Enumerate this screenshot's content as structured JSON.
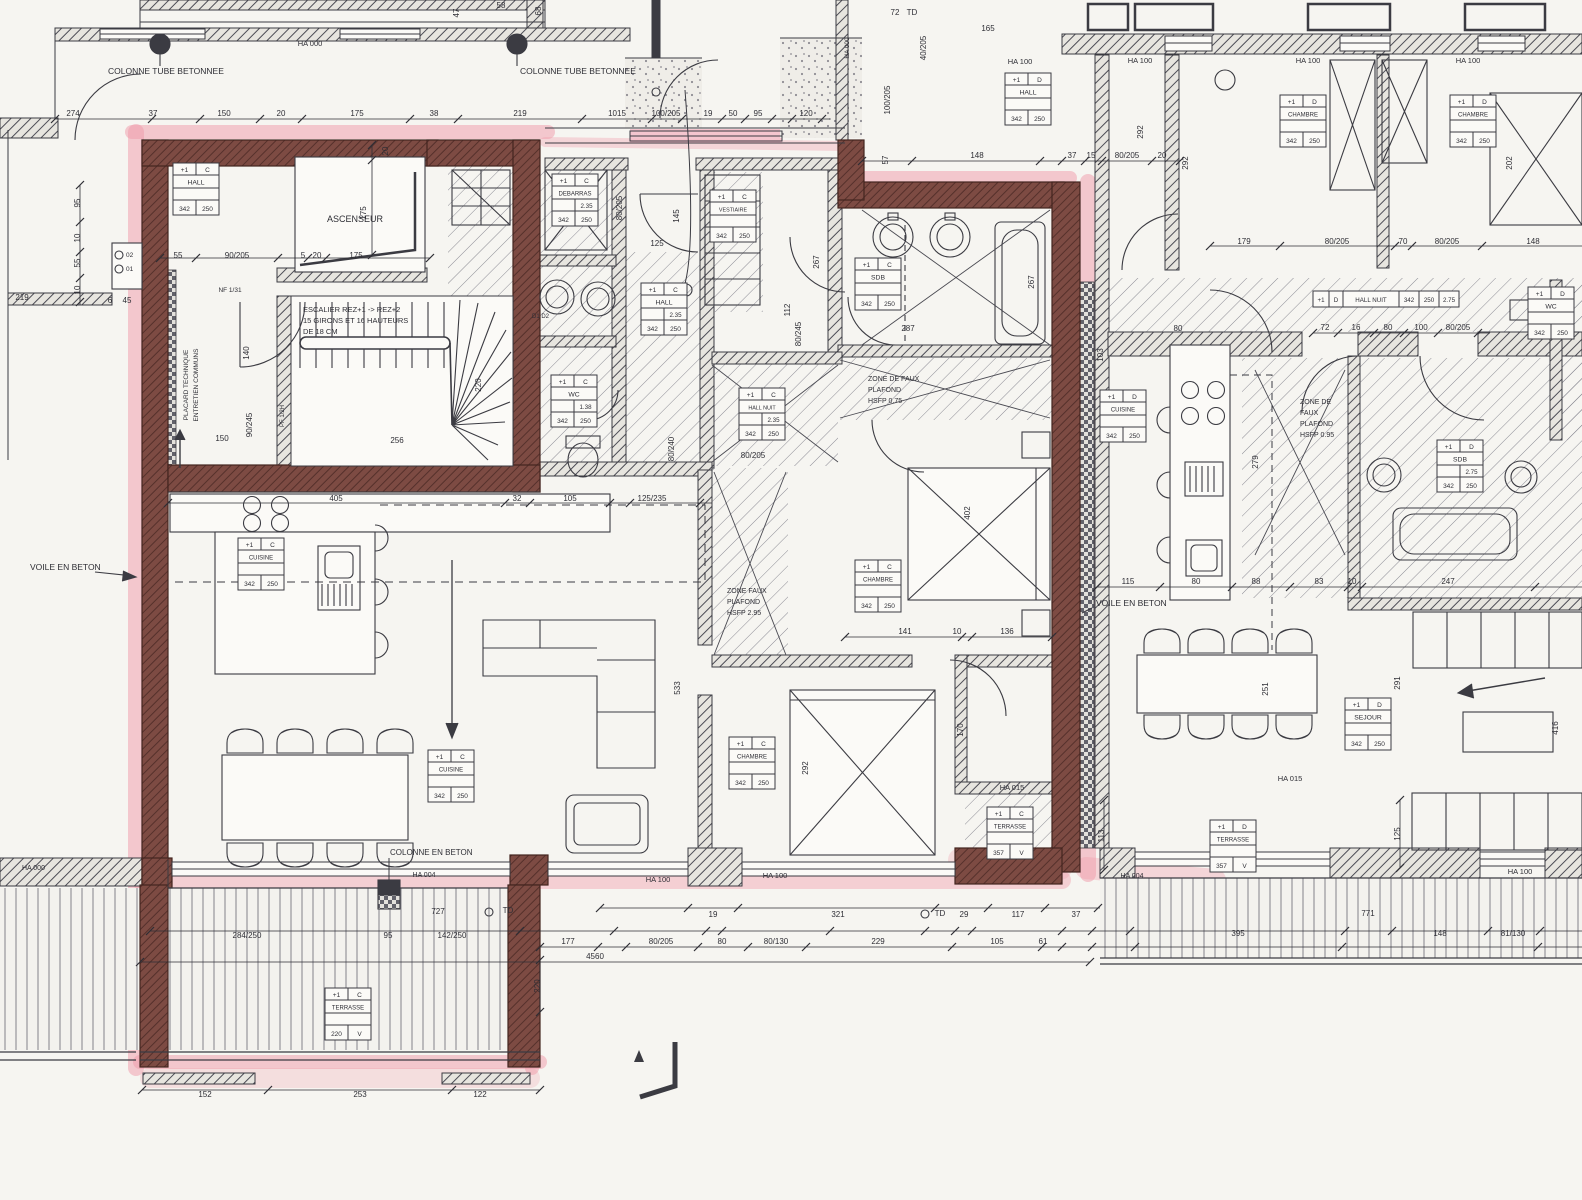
{
  "drawing": {
    "kind": "architectural floor plan scan",
    "paper_color": "#f6f5f1",
    "ink_color": "#3b3b42",
    "highlight_pink": "#f09aa9",
    "highlight_wall": "#7a4a42",
    "tag_code_a": "342",
    "tag_code_b": "250",
    "floor_code": "+1"
  },
  "room_tags": [
    {
      "n": "tag-hall-main",
      "f": "+1",
      "l": "C",
      "name": "HALL",
      "v": "",
      "a": "342",
      "b": "250",
      "x": 173,
      "y": 163,
      "o": "v"
    },
    {
      "n": "tag-debarras",
      "f": "+1",
      "l": "C",
      "name": "DEBARRAS",
      "v": "2.35",
      "a": "342",
      "b": "250",
      "x": 552,
      "y": 174,
      "o": "v"
    },
    {
      "n": "tag-vestiaire",
      "f": "+1",
      "l": "C",
      "name": "VESTIAIRE",
      "v": "",
      "a": "342",
      "b": "250",
      "x": 710,
      "y": 190,
      "o": "v"
    },
    {
      "n": "tag-hall-center",
      "f": "+1",
      "l": "C",
      "name": "HALL",
      "v": "2.35",
      "a": "342",
      "b": "250",
      "x": 641,
      "y": 283,
      "o": "v"
    },
    {
      "n": "tag-wc-main",
      "f": "+1",
      "l": "C",
      "name": "WC",
      "v": "1.38",
      "a": "342",
      "b": "250",
      "x": 551,
      "y": 375,
      "o": "v"
    },
    {
      "n": "tag-sdb-main",
      "f": "+1",
      "l": "C",
      "name": "SDB",
      "v": "",
      "a": "342",
      "b": "250",
      "x": 855,
      "y": 258,
      "o": "v"
    },
    {
      "n": "tag-chambre-main-1",
      "f": "+1",
      "l": "C",
      "name": "CHAMBRE",
      "v": "",
      "a": "342",
      "b": "250",
      "x": 855,
      "y": 560,
      "o": "v"
    },
    {
      "n": "tag-chambre-main-2",
      "f": "+1",
      "l": "C",
      "name": "CHAMBRE",
      "v": "",
      "a": "342",
      "b": "250",
      "x": 729,
      "y": 737,
      "o": "v"
    },
    {
      "n": "tag-cuisine-main-1",
      "f": "+1",
      "l": "C",
      "name": "CUISINE",
      "v": "",
      "a": "342",
      "b": "250",
      "x": 238,
      "y": 538,
      "o": "v"
    },
    {
      "n": "tag-cuisine-main-2",
      "f": "+1",
      "l": "C",
      "name": "CUISINE",
      "v": "",
      "a": "342",
      "b": "250",
      "x": 428,
      "y": 750,
      "o": "v"
    },
    {
      "n": "tag-hall-nuit-main",
      "f": "+1",
      "l": "C",
      "name": "HALL NUIT",
      "v": "2.35",
      "a": "342",
      "b": "250",
      "x": 739,
      "y": 388,
      "o": "v"
    },
    {
      "n": "tag-terrasse-main-big",
      "f": "+1",
      "l": "C",
      "name": "TERRASSE",
      "v": "",
      "a": "220",
      "b": "V",
      "x": 325,
      "y": 988,
      "o": "v"
    },
    {
      "n": "tag-terrasse-main-small",
      "f": "+1",
      "l": "C",
      "name": "TERRASSE",
      "v": "",
      "a": "357",
      "b": "V",
      "x": 987,
      "y": 807,
      "o": "v"
    },
    {
      "n": "tag-hall-right",
      "f": "+1",
      "l": "D",
      "name": "HALL",
      "v": "",
      "a": "342",
      "b": "250",
      "x": 1005,
      "y": 73,
      "o": "v"
    },
    {
      "n": "tag-chambre-right-1",
      "f": "+1",
      "l": "D",
      "name": "CHAMBRE",
      "v": "",
      "a": "342",
      "b": "250",
      "x": 1280,
      "y": 95,
      "o": "v"
    },
    {
      "n": "tag-chambre-right-2",
      "f": "+1",
      "l": "D",
      "name": "CHAMBRE",
      "v": "",
      "a": "342",
      "b": "250",
      "x": 1450,
      "y": 95,
      "o": "v"
    },
    {
      "n": "tag-cuisine-right",
      "f": "+1",
      "l": "D",
      "name": "CUISINE",
      "v": "",
      "a": "342",
      "b": "250",
      "x": 1100,
      "y": 390,
      "o": "v"
    },
    {
      "n": "tag-sejour-right",
      "f": "+1",
      "l": "D",
      "name": "SEJOUR",
      "v": "",
      "a": "342",
      "b": "250",
      "x": 1345,
      "y": 698,
      "o": "v"
    },
    {
      "n": "tag-sdb-right",
      "f": "+1",
      "l": "D",
      "name": "SDB",
      "v": "2.75",
      "a": "342",
      "b": "250",
      "x": 1437,
      "y": 440,
      "o": "v"
    },
    {
      "n": "tag-wc-right",
      "f": "+1",
      "l": "D",
      "name": "WC",
      "v": "",
      "a": "342",
      "b": "250",
      "x": 1528,
      "y": 287,
      "o": "v"
    },
    {
      "n": "tag-terrasse-right",
      "f": "+1",
      "l": "D",
      "name": "TERRASSE",
      "v": "",
      "a": "357",
      "b": "V",
      "x": 1210,
      "y": 820,
      "o": "v"
    },
    {
      "n": "tag-hall-nuit-right",
      "f": "+1",
      "l": "D",
      "name": "HALL NUIT",
      "cells": [
        "342",
        "250",
        "2.75"
      ],
      "x": 1313,
      "y": 291,
      "o": "h"
    }
  ],
  "labels": [
    {
      "n": "colonne-tube-1",
      "t": "COLONNE TUBE BETONNEE",
      "x": 108,
      "y": 74,
      "s": 8.5,
      "a": "start"
    },
    {
      "n": "colonne-tube-2",
      "t": "COLONNE TUBE BETONNEE",
      "x": 520,
      "y": 74,
      "s": 8.5,
      "a": "start"
    },
    {
      "n": "colonne-beton",
      "t": "COLONNE EN BETON",
      "x": 390,
      "y": 855,
      "s": 8,
      "a": "start"
    },
    {
      "n": "voile-beton-left",
      "t": "VOILE EN BETON",
      "x": 30,
      "y": 570,
      "s": 8.5,
      "a": "start"
    },
    {
      "n": "voile-beton-right",
      "t": "VOILE EN BETON",
      "x": 1096,
      "y": 606,
      "s": 8.5,
      "a": "start"
    },
    {
      "n": "ascenseur",
      "t": "ASCENSEUR",
      "x": 355,
      "y": 222,
      "s": 9,
      "a": "middle"
    },
    {
      "n": "escalier-1",
      "t": "ESCALIER REZ+1 -> REZ+2",
      "x": 303,
      "y": 312,
      "s": 7.5,
      "a": "start"
    },
    {
      "n": "escalier-2",
      "t": "15 GIRONS ET 16 HAUTEURS",
      "x": 303,
      "y": 323,
      "s": 7.5,
      "a": "start"
    },
    {
      "n": "escalier-3",
      "t": "DE 18 CM",
      "x": 303,
      "y": 334,
      "s": 7.5,
      "a": "start"
    },
    {
      "n": "placard-1",
      "t": "PLACARD TECHNIQUE",
      "x": 188,
      "y": 385,
      "s": 6.5,
      "a": "middle",
      "r": 1
    },
    {
      "n": "placard-2",
      "t": "ENTRETIEN COMMUNS",
      "x": 198,
      "y": 385,
      "s": 6.5,
      "a": "middle",
      "r": 1
    },
    {
      "n": "zone-faux-1a",
      "t": "ZONE DE FAUX",
      "x": 868,
      "y": 381,
      "s": 7,
      "a": "start"
    },
    {
      "n": "zone-faux-1b",
      "t": "PLAFOND",
      "x": 868,
      "y": 392,
      "s": 7,
      "a": "start"
    },
    {
      "n": "zone-faux-1c",
      "t": "HSFP 0.75",
      "x": 868,
      "y": 403,
      "s": 7,
      "a": "start"
    },
    {
      "n": "zone-faux-2a",
      "t": "ZONE FAUX",
      "x": 727,
      "y": 593,
      "s": 7,
      "a": "start"
    },
    {
      "n": "zone-faux-2b",
      "t": "PLAFOND",
      "x": 727,
      "y": 604,
      "s": 7,
      "a": "start"
    },
    {
      "n": "zone-faux-2c",
      "t": "HSFP 2.95",
      "x": 727,
      "y": 615,
      "s": 7,
      "a": "start"
    },
    {
      "n": "zone-faux-3a",
      "t": "ZONE DE",
      "x": 1300,
      "y": 404,
      "s": 7,
      "a": "start"
    },
    {
      "n": "zone-faux-3b",
      "t": "FAUX",
      "x": 1300,
      "y": 415,
      "s": 7,
      "a": "start"
    },
    {
      "n": "zone-faux-3c",
      "t": "PLAFOND",
      "x": 1300,
      "y": 426,
      "s": 7,
      "a": "start"
    },
    {
      "n": "zone-faux-3d",
      "t": "HSFP 0.95",
      "x": 1300,
      "y": 437,
      "s": 7,
      "a": "start"
    },
    {
      "n": "ha000-top",
      "t": "HA 000",
      "x": 310,
      "y": 46,
      "s": 7.5,
      "a": "middle"
    },
    {
      "n": "ha000-landing",
      "t": "HA 000",
      "x": 849,
      "y": 48,
      "s": 6.5,
      "a": "middle",
      "r": 1
    },
    {
      "n": "ha000-bottomleft",
      "t": "HA 000",
      "x": 22,
      "y": 870,
      "s": 7,
      "a": "start"
    },
    {
      "n": "ha100-1",
      "t": "HA 100",
      "x": 1020,
      "y": 64,
      "s": 7.5,
      "a": "middle"
    },
    {
      "n": "ha100-2",
      "t": "HA 100",
      "x": 1140,
      "y": 63,
      "s": 7.5,
      "a": "middle"
    },
    {
      "n": "ha100-3",
      "t": "HA 100",
      "x": 1308,
      "y": 63,
      "s": 7.5,
      "a": "middle"
    },
    {
      "n": "ha100-4",
      "t": "HA 100",
      "x": 1468,
      "y": 63,
      "s": 7.5,
      "a": "middle"
    },
    {
      "n": "ha100-5",
      "t": "HA 100",
      "x": 658,
      "y": 882,
      "s": 7.5,
      "a": "middle"
    },
    {
      "n": "ha100-6",
      "t": "HA 100",
      "x": 775,
      "y": 878,
      "s": 7.5,
      "a": "middle"
    },
    {
      "n": "ha100-7",
      "t": "HA 100",
      "x": 1520,
      "y": 874,
      "s": 7.5,
      "a": "middle"
    },
    {
      "n": "ha015-1",
      "t": "HA 015",
      "x": 1012,
      "y": 790,
      "s": 7.5,
      "a": "middle"
    },
    {
      "n": "ha015-2",
      "t": "HA 015",
      "x": 1290,
      "y": 781,
      "s": 7.5,
      "a": "middle"
    },
    {
      "n": "ha004-1",
      "t": "HA 004",
      "x": 424,
      "y": 877,
      "s": 7,
      "a": "middle"
    },
    {
      "n": "ha004-2",
      "t": "HA 004",
      "x": 1132,
      "y": 878,
      "s": 7,
      "a": "middle"
    },
    {
      "n": "washer-ids",
      "t": "D1 D2",
      "x": 532,
      "y": 318,
      "s": 6,
      "a": "start"
    },
    {
      "n": "duct-02",
      "t": "02",
      "x": 126,
      "y": 257,
      "s": 6.5,
      "a": "start"
    },
    {
      "n": "duct-01",
      "t": "01",
      "x": 126,
      "y": 271,
      "s": 6.5,
      "a": "start"
    },
    {
      "n": "nf-label",
      "t": "NF 1/31",
      "x": 230,
      "y": 292,
      "s": 6.5,
      "a": "middle"
    },
    {
      "n": "pf-label",
      "t": "PF 1/2H",
      "x": 284,
      "y": 416,
      "s": 6,
      "a": "middle",
      "r": 1
    }
  ],
  "dims": [
    {
      "t": "274",
      "x": 73,
      "y": 116
    },
    {
      "t": "37",
      "x": 153,
      "y": 116
    },
    {
      "t": "150",
      "x": 224,
      "y": 116
    },
    {
      "t": "20",
      "x": 281,
      "y": 116
    },
    {
      "t": "175",
      "x": 357,
      "y": 116
    },
    {
      "t": "38",
      "x": 434,
      "y": 116
    },
    {
      "t": "219",
      "x": 520,
      "y": 116
    },
    {
      "t": "1015",
      "x": 617,
      "y": 116
    },
    {
      "t": "100/205",
      "x": 666,
      "y": 116
    },
    {
      "t": "19",
      "x": 708,
      "y": 116
    },
    {
      "t": "50",
      "x": 733,
      "y": 116
    },
    {
      "t": "95",
      "x": 758,
      "y": 116
    },
    {
      "t": "120",
      "x": 806,
      "y": 116
    },
    {
      "t": "47",
      "x": 459,
      "y": 13,
      "r": 1
    },
    {
      "t": "58",
      "x": 501,
      "y": 8
    },
    {
      "t": "68",
      "x": 541,
      "y": 11,
      "r": 1
    },
    {
      "t": "72",
      "x": 895,
      "y": 15
    },
    {
      "t": "TD",
      "x": 912,
      "y": 15
    },
    {
      "t": "165",
      "x": 988,
      "y": 31
    },
    {
      "t": "40/205",
      "x": 926,
      "y": 48,
      "r": 1
    },
    {
      "t": "95",
      "x": 80,
      "y": 203,
      "r": 1
    },
    {
      "t": "10",
      "x": 80,
      "y": 238,
      "r": 1
    },
    {
      "t": "55",
      "x": 80,
      "y": 263,
      "r": 1
    },
    {
      "t": "10",
      "x": 80,
      "y": 290,
      "r": 1
    },
    {
      "t": "219",
      "x": 22,
      "y": 300
    },
    {
      "t": "6",
      "x": 110,
      "y": 303
    },
    {
      "t": "45",
      "x": 127,
      "y": 303
    },
    {
      "t": "20",
      "x": 388,
      "y": 151,
      "r": 1
    },
    {
      "t": "175",
      "x": 366,
      "y": 213,
      "r": 1
    },
    {
      "t": "55",
      "x": 178,
      "y": 258
    },
    {
      "t": "90/205",
      "x": 237,
      "y": 258
    },
    {
      "t": "5",
      "x": 303,
      "y": 258
    },
    {
      "t": "20",
      "x": 317,
      "y": 258
    },
    {
      "t": "175",
      "x": 356,
      "y": 258
    },
    {
      "t": "140",
      "x": 249,
      "y": 353,
      "r": 1
    },
    {
      "t": "90/245",
      "x": 252,
      "y": 425,
      "r": 1
    },
    {
      "t": "150",
      "x": 222,
      "y": 441
    },
    {
      "t": "256",
      "x": 397,
      "y": 443
    },
    {
      "t": "220",
      "x": 481,
      "y": 385,
      "r": 1
    },
    {
      "t": "125",
      "x": 657,
      "y": 246
    },
    {
      "t": "80/205",
      "x": 622,
      "y": 208,
      "r": 1
    },
    {
      "t": "145",
      "x": 679,
      "y": 216,
      "r": 1
    },
    {
      "t": "405",
      "x": 336,
      "y": 501
    },
    {
      "t": "32",
      "x": 517,
      "y": 501
    },
    {
      "t": "105",
      "x": 570,
      "y": 501
    },
    {
      "t": "125/235",
      "x": 652,
      "y": 501
    },
    {
      "t": "80/240",
      "x": 674,
      "y": 449,
      "r": 1
    },
    {
      "t": "267",
      "x": 819,
      "y": 262,
      "r": 1
    },
    {
      "t": "112",
      "x": 790,
      "y": 310,
      "r": 1
    },
    {
      "t": "80/245",
      "x": 801,
      "y": 334,
      "r": 1
    },
    {
      "t": "100/205",
      "x": 890,
      "y": 100,
      "r": 1
    },
    {
      "t": "57",
      "x": 888,
      "y": 160,
      "r": 1
    },
    {
      "t": "148",
      "x": 977,
      "y": 158
    },
    {
      "t": "37",
      "x": 1072,
      "y": 158
    },
    {
      "t": "15",
      "x": 1091,
      "y": 158
    },
    {
      "t": "80/205",
      "x": 1127,
      "y": 158
    },
    {
      "t": "20",
      "x": 1162,
      "y": 158
    },
    {
      "t": "287",
      "x": 908,
      "y": 331
    },
    {
      "t": "267",
      "x": 1034,
      "y": 282,
      "r": 1
    },
    {
      "t": "402",
      "x": 970,
      "y": 513,
      "r": 1
    },
    {
      "t": "141",
      "x": 905,
      "y": 634
    },
    {
      "t": "10",
      "x": 957,
      "y": 634
    },
    {
      "t": "136",
      "x": 1007,
      "y": 634
    },
    {
      "t": "80/205",
      "x": 753,
      "y": 458
    },
    {
      "t": "292",
      "x": 808,
      "y": 768,
      "r": 1
    },
    {
      "t": "170",
      "x": 963,
      "y": 730,
      "r": 1
    },
    {
      "t": "533",
      "x": 680,
      "y": 688,
      "r": 1
    },
    {
      "t": "19",
      "x": 713,
      "y": 917
    },
    {
      "t": "321",
      "x": 838,
      "y": 917
    },
    {
      "t": "TD",
      "x": 940,
      "y": 916
    },
    {
      "t": "29",
      "x": 964,
      "y": 917
    },
    {
      "t": "117",
      "x": 1018,
      "y": 917
    },
    {
      "t": "37",
      "x": 1076,
      "y": 917
    },
    {
      "t": "771",
      "x": 1368,
      "y": 916
    },
    {
      "t": "177",
      "x": 568,
      "y": 944
    },
    {
      "t": "80/205",
      "x": 661,
      "y": 944
    },
    {
      "t": "80",
      "x": 722,
      "y": 944
    },
    {
      "t": "80/130",
      "x": 776,
      "y": 944
    },
    {
      "t": "229",
      "x": 878,
      "y": 944
    },
    {
      "t": "105",
      "x": 997,
      "y": 944
    },
    {
      "t": "61",
      "x": 1043,
      "y": 944
    },
    {
      "t": "395",
      "x": 1238,
      "y": 936
    },
    {
      "t": "148",
      "x": 1440,
      "y": 936
    },
    {
      "t": "81/130",
      "x": 1513,
      "y": 936
    },
    {
      "t": "4560",
      "x": 595,
      "y": 959
    },
    {
      "t": "284/250",
      "x": 247,
      "y": 938
    },
    {
      "t": "95",
      "x": 388,
      "y": 938
    },
    {
      "t": "727",
      "x": 438,
      "y": 914
    },
    {
      "t": "TD",
      "x": 508,
      "y": 913
    },
    {
      "t": "142/250",
      "x": 452,
      "y": 938
    },
    {
      "t": "220",
      "x": 540,
      "y": 986,
      "r": 1
    },
    {
      "t": "152",
      "x": 205,
      "y": 1097
    },
    {
      "t": "253",
      "x": 360,
      "y": 1097
    },
    {
      "t": "122",
      "x": 480,
      "y": 1097
    },
    {
      "t": "113",
      "x": 1104,
      "y": 836,
      "r": 1
    },
    {
      "t": "125",
      "x": 1400,
      "y": 834,
      "r": 1
    },
    {
      "t": "292",
      "x": 1143,
      "y": 132,
      "r": 1
    },
    {
      "t": "292",
      "x": 1188,
      "y": 163,
      "r": 1
    },
    {
      "t": "202",
      "x": 1512,
      "y": 163,
      "r": 1
    },
    {
      "t": "179",
      "x": 1244,
      "y": 244
    },
    {
      "t": "80/205",
      "x": 1337,
      "y": 244
    },
    {
      "t": "70",
      "x": 1403,
      "y": 244
    },
    {
      "t": "80/205",
      "x": 1447,
      "y": 244
    },
    {
      "t": "148",
      "x": 1533,
      "y": 244
    },
    {
      "t": "72",
      "x": 1325,
      "y": 330
    },
    {
      "t": "16",
      "x": 1356,
      "y": 330
    },
    {
      "t": "80",
      "x": 1388,
      "y": 330
    },
    {
      "t": "100",
      "x": 1421,
      "y": 330
    },
    {
      "t": "80/205",
      "x": 1458,
      "y": 330
    },
    {
      "t": "80",
      "x": 1178,
      "y": 331
    },
    {
      "t": "279",
      "x": 1258,
      "y": 462,
      "r": 1
    },
    {
      "t": "103",
      "x": 1103,
      "y": 355,
      "r": 1
    },
    {
      "t": "115",
      "x": 1128,
      "y": 584
    },
    {
      "t": "80",
      "x": 1196,
      "y": 584
    },
    {
      "t": "88",
      "x": 1256,
      "y": 584
    },
    {
      "t": "83",
      "x": 1319,
      "y": 584
    },
    {
      "t": "10",
      "x": 1352,
      "y": 584
    },
    {
      "t": "247",
      "x": 1448,
      "y": 584
    },
    {
      "t": "251",
      "x": 1268,
      "y": 689,
      "r": 1
    },
    {
      "t": "291",
      "x": 1400,
      "y": 683,
      "r": 1
    },
    {
      "t": "416",
      "x": 1558,
      "y": 728,
      "r": 1
    }
  ]
}
